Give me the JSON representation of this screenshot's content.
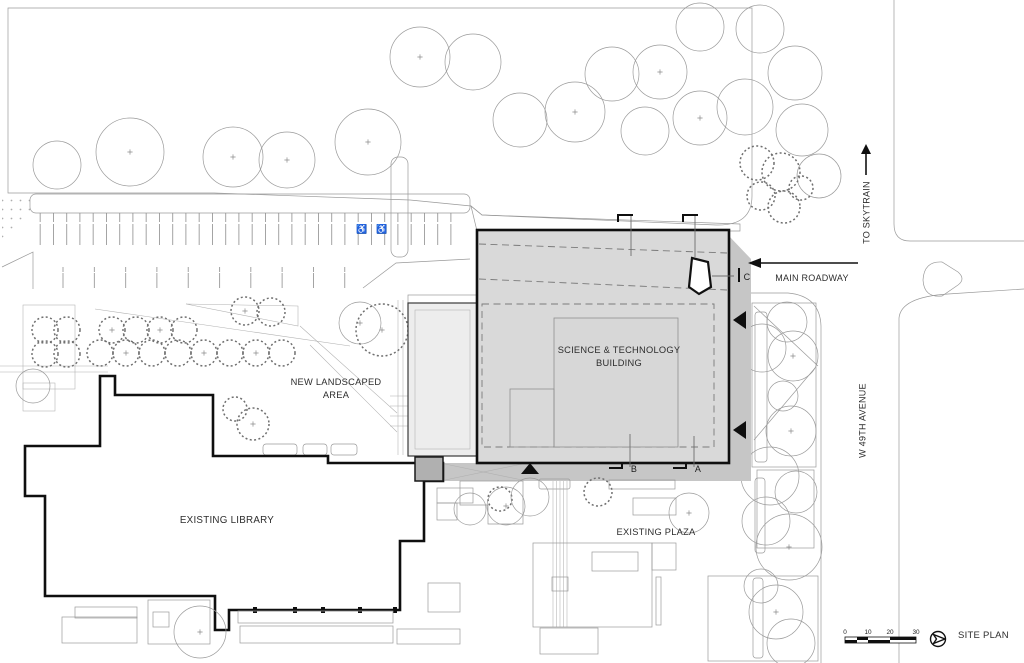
{
  "plan": {
    "title": "SITE PLAN",
    "labels": {
      "building_line1": "SCIENCE & TECHNOLOGY",
      "building_line2": "BUILDING",
      "landscaped_line1": "NEW LANDSCAPED",
      "landscaped_line2": "AREA",
      "library": "EXISTING LIBRARY",
      "plaza": "EXISTING PLAZA",
      "roadway": "MAIN ROADWAY",
      "skytrain": "TO SKYTRAIN",
      "avenue": "W 49TH AVENUE"
    },
    "section_markers": {
      "a": "A",
      "b": "B",
      "c": "C"
    },
    "scale_bar": {
      "ticks": [
        "0",
        "10",
        "20",
        "30"
      ]
    },
    "icons": {
      "accessible_parking": "♿"
    },
    "colors": {
      "building_fill": "#d9d9d9",
      "building_shadow": "#c6c6c6",
      "wing_fill": "#ededed",
      "connector_fill": "#b0b0b0",
      "outline": "#0f0f0f"
    }
  }
}
